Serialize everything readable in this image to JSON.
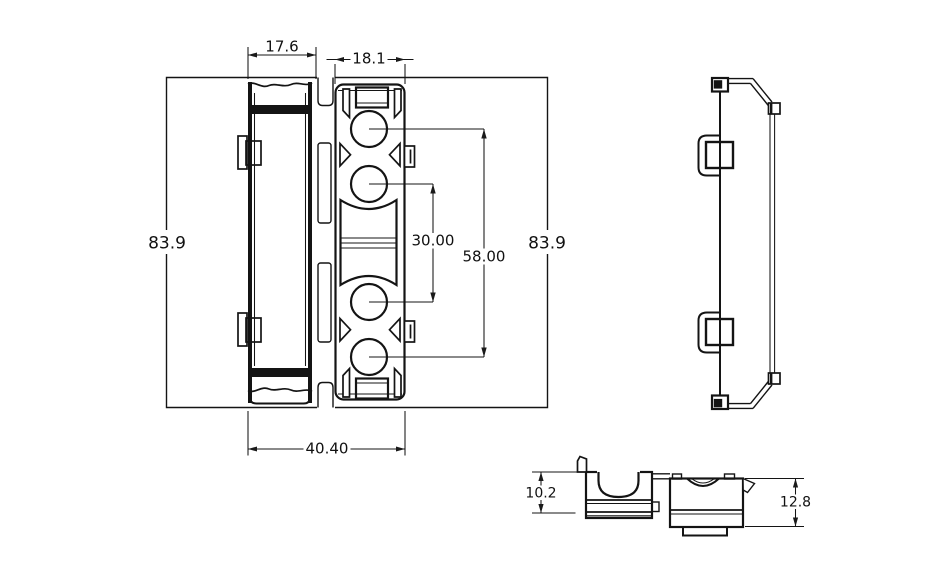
{
  "style": {
    "background": "#ffffff",
    "line_color": "#141414",
    "text_color": "#111111"
  },
  "front_view": {
    "dims": {
      "channel_width": "17.6",
      "slot_width": "18.1",
      "height_left": "83.9",
      "height_right": "83.9",
      "hole_pitch_inner": "30.00",
      "hole_pitch_outer": "58.00",
      "base_width": "40.40"
    }
  },
  "detail_view": {
    "dims": {
      "saddle_height": "10.2",
      "body_height": "12.8"
    }
  }
}
